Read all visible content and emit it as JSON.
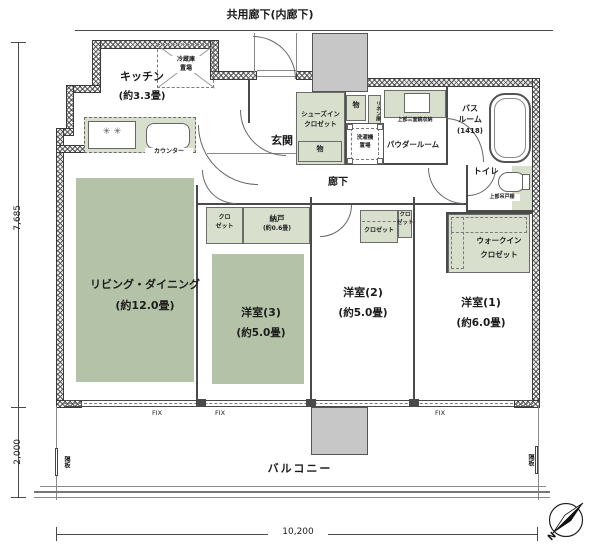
{
  "plan": {
    "common_corridor": "共用廊下(内廊下)",
    "compass_label": "N",
    "dims": {
      "left_upper": "7,685",
      "left_lower": "2,000",
      "bottom": "10,200"
    },
    "partition": "隔板",
    "fix": "FIX",
    "rooms": {
      "kitchen": {
        "name": "キッチン",
        "size": "(約3.3畳)"
      },
      "living": {
        "name": "リビング・ダイニング",
        "size": "(約12.0畳)"
      },
      "western3": {
        "name": "洋室(3)",
        "size": "(約5.0畳)"
      },
      "western2": {
        "name": "洋室(2)",
        "size": "(約5.0畳)"
      },
      "western1": {
        "name": "洋室(1)",
        "size": "(約6.0畳)"
      },
      "entrance": "玄関",
      "hallway": "廊下",
      "powder": "パウダールーム",
      "bath": {
        "line1": "バス",
        "line2": "ルーム",
        "size": "(1418)"
      },
      "toilet": "トイレ",
      "wic": {
        "line1": "ウォークイン",
        "line2": "クロゼット"
      },
      "sic": {
        "line1": "シューズイン",
        "line2": "クロゼット"
      },
      "storage": {
        "name": "納戸",
        "size": "(約0.6畳)"
      },
      "balcony": "バルコニー"
    },
    "fixtures": {
      "fridge": {
        "line1": "冷蔵庫",
        "line2": "置場"
      },
      "counter": "カウンター",
      "washer": {
        "line1": "洗濯機",
        "line2": "置場"
      },
      "stove_symbol": "✳ ✳",
      "mirror": "上部三面鏡収納",
      "toilet_shelf": "上部吊戸棚",
      "linen": "リネン庫",
      "closet": "クロゼット",
      "closet_s1": "クロ",
      "closet_s2": "ゼット",
      "mono": "物"
    }
  }
}
